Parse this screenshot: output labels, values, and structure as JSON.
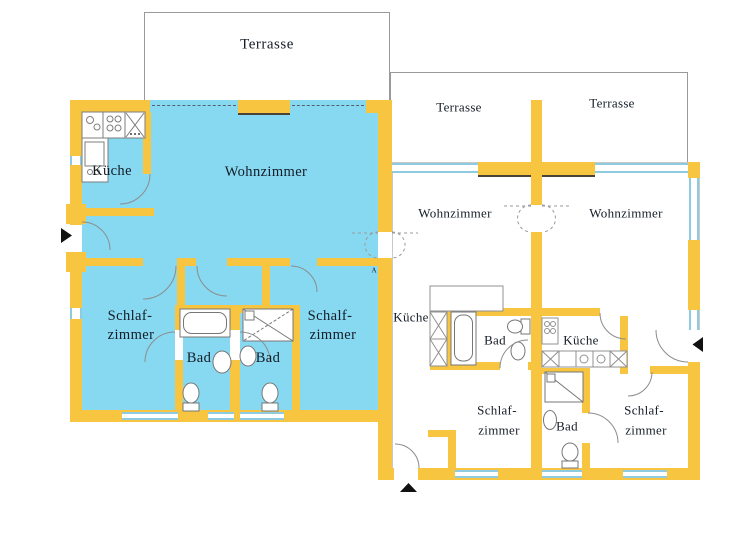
{
  "left_apartment": {
    "terrace_label": "Terrasse",
    "kitchen_label": "Küche",
    "living_room_label": "Wohnzimmer",
    "bedroom_left": {
      "line1": "Schlaf-",
      "line2": "zimmer"
    },
    "bathroom_left_label": "Bad",
    "bathroom_right_label": "Bad",
    "bedroom_right": {
      "line1": "Schalf-",
      "line2": "zimmer"
    },
    "section_marker": "A"
  },
  "right_building": {
    "unit_left": {
      "terrace_label": "Terrasse",
      "living_room_label": "Wohnzimmer",
      "kitchen_label": "Küche",
      "bathroom_label": "Bad",
      "bedroom": {
        "line1": "Schlaf-",
        "line2": "zimmer"
      }
    },
    "unit_right": {
      "terrace_label": "Terrasse",
      "living_room_label": "Wohnzimmer",
      "kitchen_label": "Küche",
      "bathroom_label": "Bad",
      "bedroom": {
        "line1": "Schlaf-",
        "line2": "zimmer"
      }
    }
  },
  "markers": {
    "west_entrance_icon": "triangle-right",
    "south_entrance_icon": "triangle-up",
    "east_entrance_icon": "triangle-left"
  },
  "colors": {
    "apartment_highlight": "#87D9F2",
    "wall": "#F7C53F",
    "window_line": "#8FCBE0",
    "terrace_outline": "#9A9A9A",
    "label_text": "#141C26",
    "marker_black": "#111111"
  }
}
